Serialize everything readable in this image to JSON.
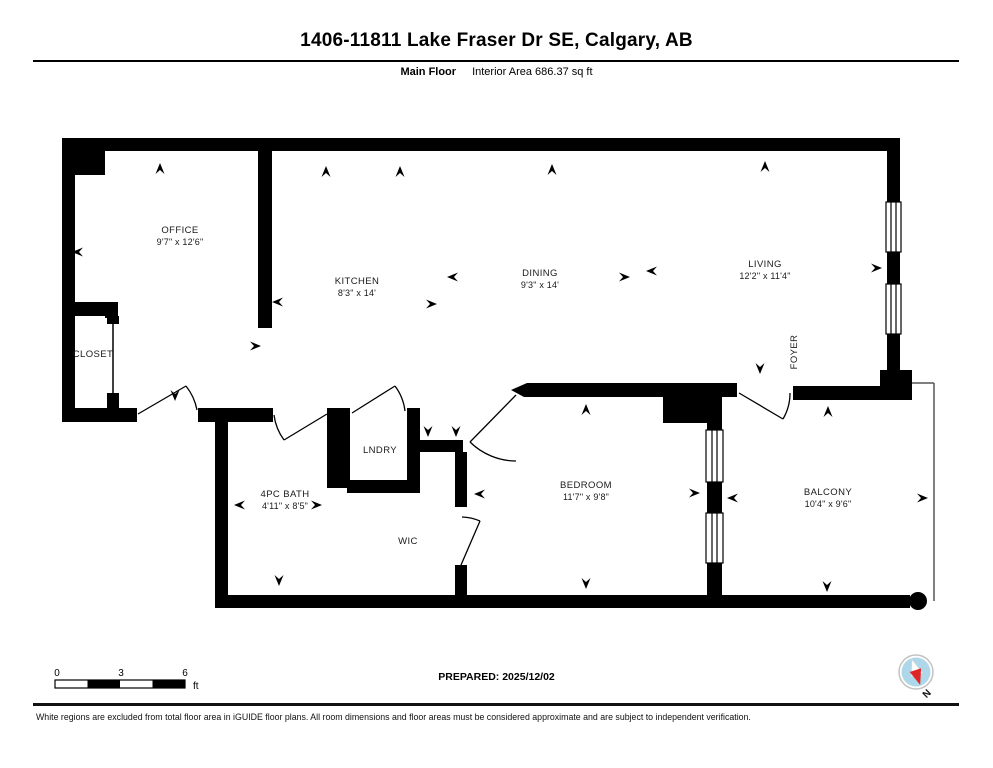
{
  "header": {
    "title": "1406-11811 Lake Fraser Dr SE, Calgary, AB",
    "floor_label": "Main Floor",
    "area_label": "Interior Area 686.37 sq ft"
  },
  "rooms": {
    "office": {
      "name": "OFFICE",
      "dims": "9'7\" x 12'6\""
    },
    "closet": {
      "name": "CLOSET",
      "dims": ""
    },
    "kitchen": {
      "name": "KITCHEN",
      "dims": "8'3\" x 14'"
    },
    "dining": {
      "name": "DINING",
      "dims": "9'3\" x 14'"
    },
    "living": {
      "name": "LIVING",
      "dims": "12'2\" x 11'4\""
    },
    "foyer": {
      "name": "FOYER",
      "dims": ""
    },
    "lndry": {
      "name": "LNDRY",
      "dims": ""
    },
    "bath": {
      "name": "4PC BATH",
      "dims": "4'11\" x 8'5\""
    },
    "wic": {
      "name": "WIC",
      "dims": ""
    },
    "bedroom": {
      "name": "BEDROOM",
      "dims": "11'7\" x 9'8\""
    },
    "balcony": {
      "name": "BALCONY",
      "dims": "10'4\" x 9'6\""
    }
  },
  "footer": {
    "scale": {
      "tick0": "0",
      "tick3": "3",
      "tick6": "6",
      "unit": "ft"
    },
    "prepared": "PREPARED: 2025/12/02",
    "compass_north": "N",
    "disclaimer": "White regions are excluded from total floor area in iGUIDE floor plans. All room dimensions and floor areas must be considered approximate and are subject to independent verification."
  },
  "colors": {
    "wall": "#000000",
    "compass_fill": "#aed7ea",
    "needle_red": "#e02527"
  }
}
